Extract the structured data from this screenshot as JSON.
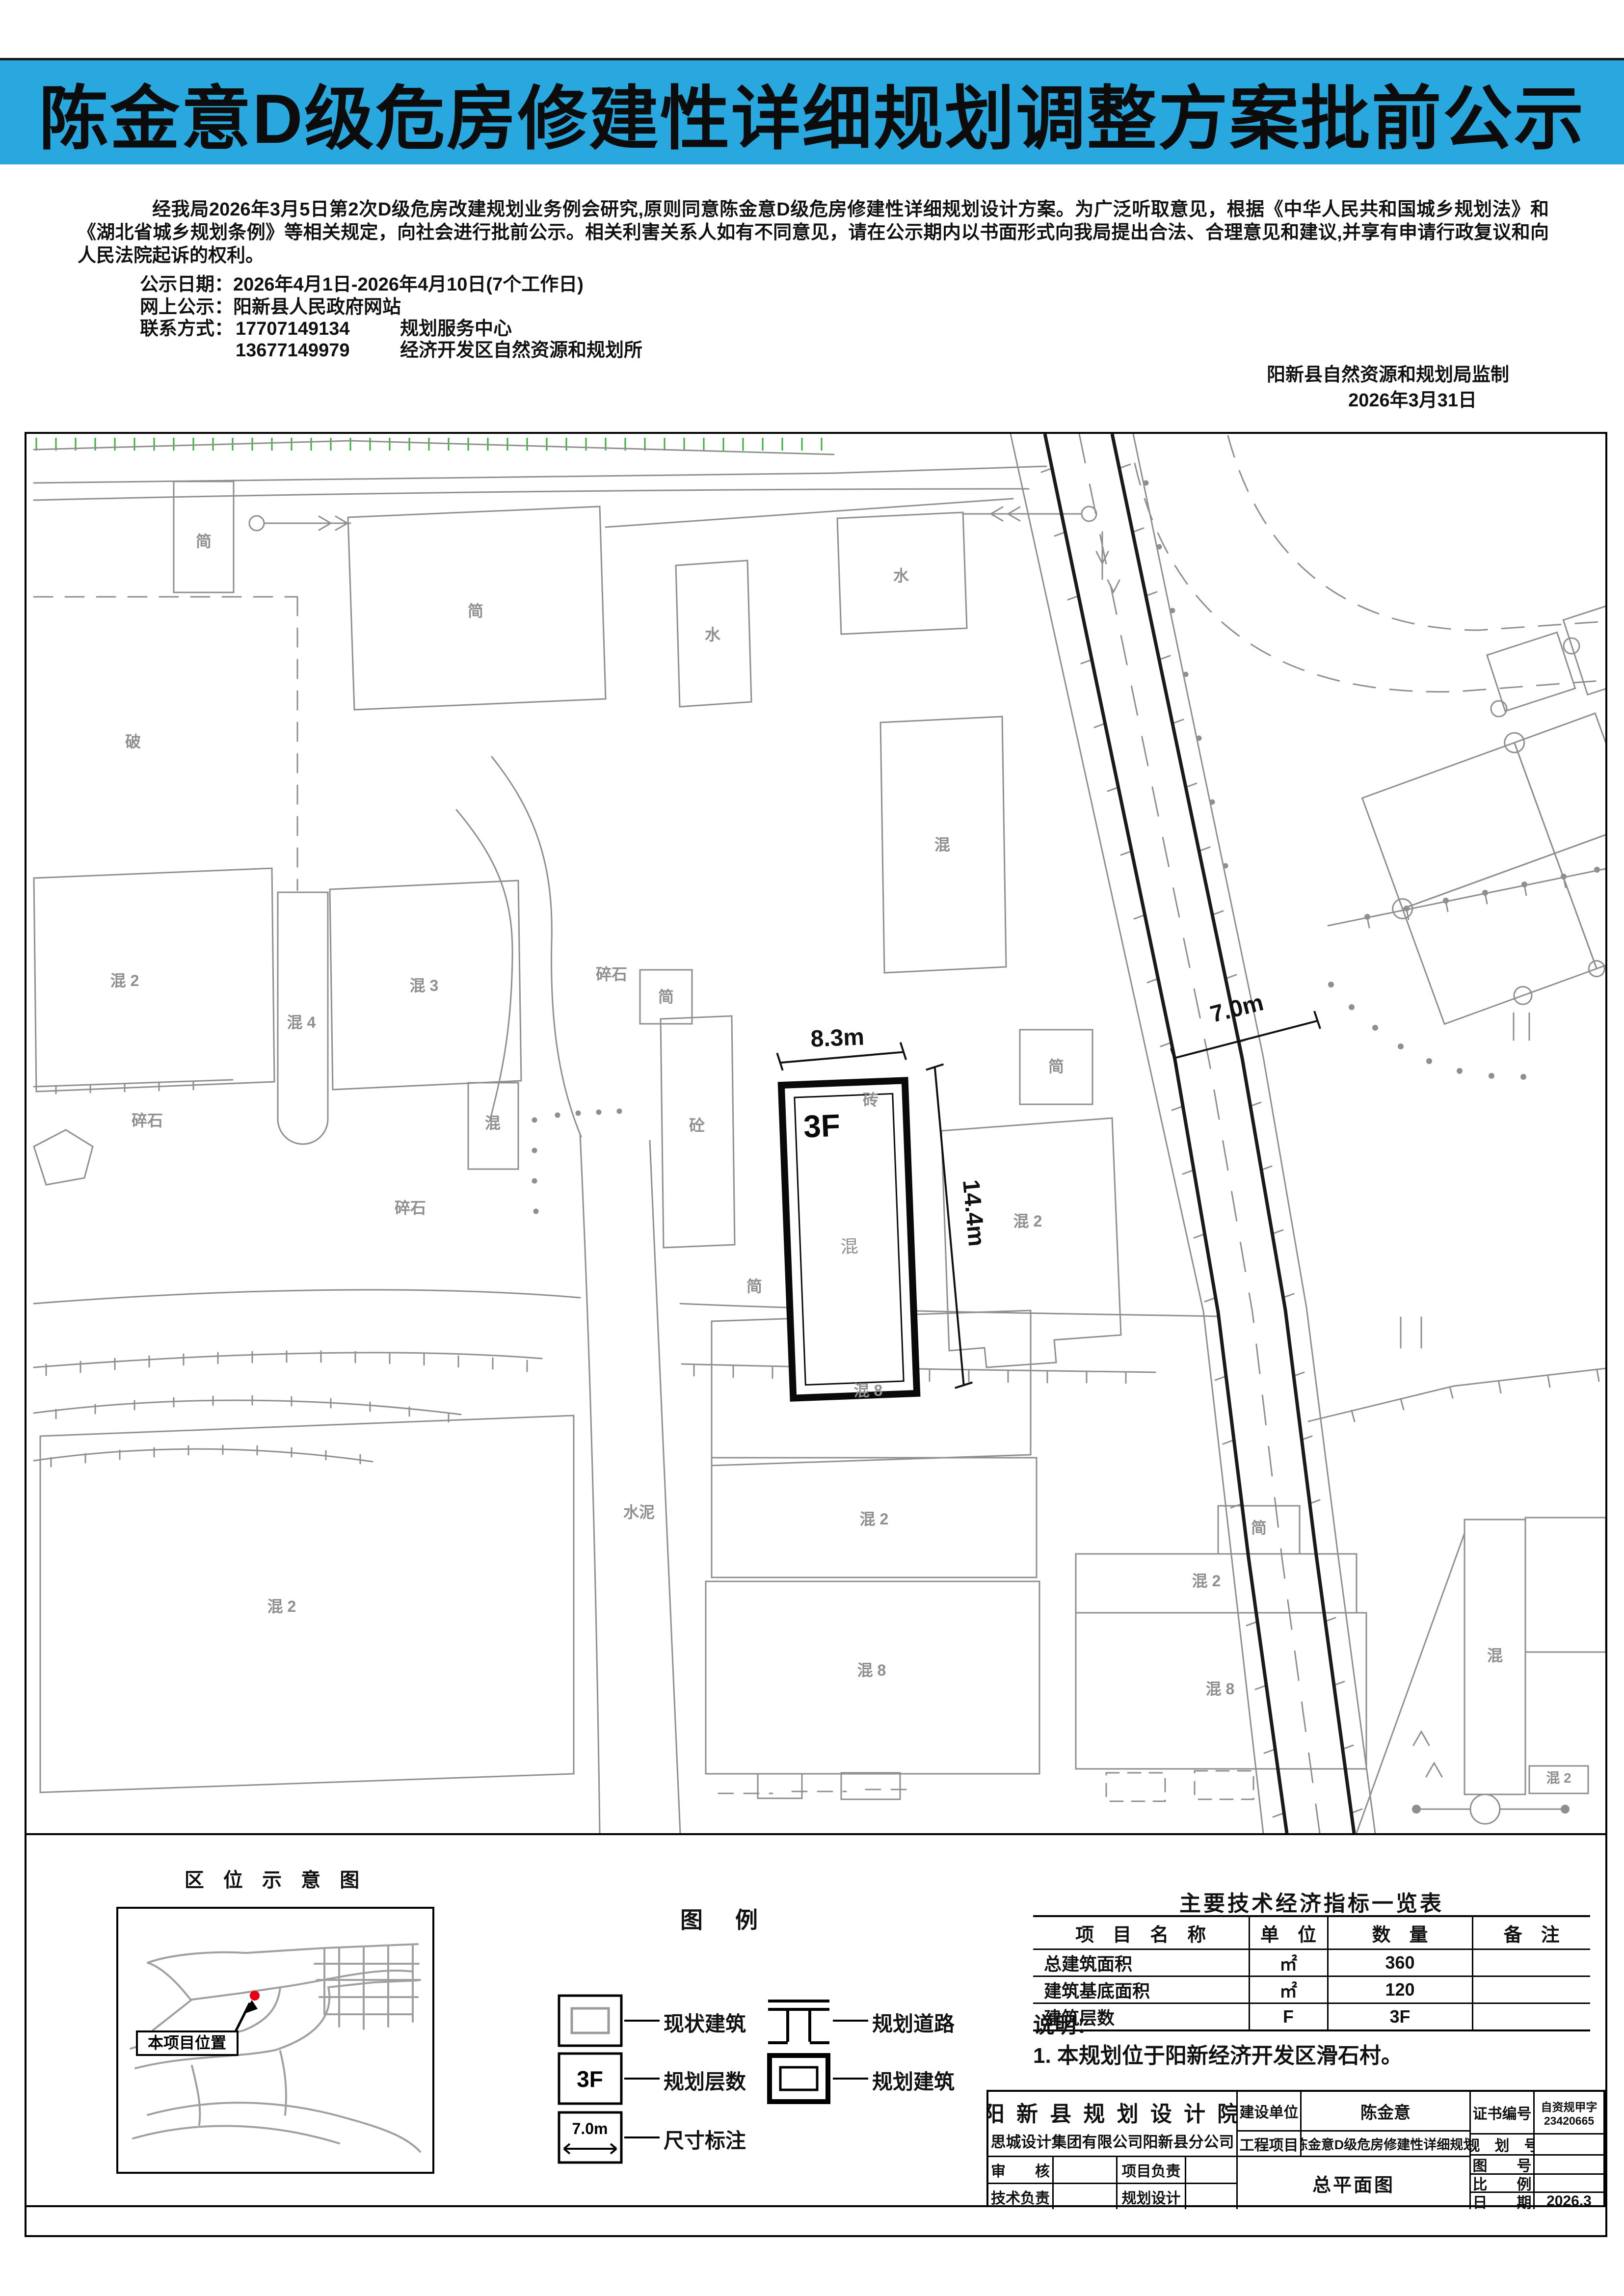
{
  "colors": {
    "banner_blue": "#29a7df",
    "vegetation_green": "#35b235",
    "map_gray": "#8f8f8f",
    "marker_red": "#e60012"
  },
  "page": {
    "title": "陈金意D级危房修建性详细规划调整方案批前公示",
    "intro": "经我局2026年3月5日第2次D级危房改建规划业务例会研究,原则同意陈金意D级危房修建性详细规划设计方案。为广泛听取意见，根据《中华人民共和国城乡规划法》和《湖北省城乡规划条例》等相关规定，向社会进行批前公示。相关利害关系人如有不同意见，请在公示期内以书面形式向我局提出合法、合理意见和建议,并享有申请行政复议和向人民法院起诉的权利。",
    "date_label": "公示日期：",
    "date_value": "2026年4月1日-2026年4月10日(7个工作日)",
    "web_label": "网上公示：",
    "web_value": "阳新县人民政府网站",
    "contact_label": "联系方式：",
    "phone1": "17707149134",
    "dept1": "规划服务中心",
    "phone2": "13677149979",
    "dept2": "经济开发区自然资源和规划所",
    "issuer": "阳新县自然资源和规划局监制",
    "issue_date": "2026年3月31日"
  },
  "map": {
    "planned": {
      "floors": "3F",
      "mat": "混"
    },
    "dims": {
      "w": "8.3m",
      "h": "14.4m",
      "road": "7.0m"
    }
  },
  "mapLabels": [
    "简",
    "简",
    "水",
    "水",
    "破",
    "混 2",
    "混 4",
    "混 3",
    "混",
    "砼",
    "碎石",
    "碎石",
    "碎石",
    "简",
    "简",
    "混 2",
    "简",
    "混",
    "砖",
    "水泥",
    "混 2",
    "混 8",
    "混 2",
    "混 8",
    "简",
    "混 2",
    "混 8",
    "混",
    "混 2"
  ],
  "location_map": {
    "title": "区 位 示 意 图",
    "marker": "本项目位置"
  },
  "legend": {
    "title": "图　例",
    "items": [
      {
        "label": "现状建筑"
      },
      {
        "label": "规划道路"
      },
      {
        "label": "规划层数",
        "symbol": "3F"
      },
      {
        "label": "规划建筑"
      },
      {
        "label": "尺寸标注",
        "symbol": "7.0m"
      }
    ]
  },
  "table": {
    "title": "主要技术经济指标一览表",
    "headers": [
      "项　目　名　称",
      "单　位",
      "数　量",
      "备　注"
    ],
    "rows": [
      [
        "总建筑面积",
        "㎡",
        "360",
        ""
      ],
      [
        "建筑基底面积",
        "㎡",
        "120",
        ""
      ],
      [
        "建筑层数",
        "F",
        "3F",
        ""
      ]
    ]
  },
  "notes": {
    "heading": "说明：",
    "line1": "1. 本规划位于阳新经济开发区滑石村。"
  },
  "titleblock": {
    "designer1": "阳 新 县 规 划 设 计 院",
    "designer2": "思城设计集团有限公司阳新县分公司",
    "client_label": "建设单位",
    "client": "陈金意",
    "project_label": "工程项目",
    "project": "陈金意D级危房修建性详细规划",
    "cert_label": "证书编号",
    "cert1": "自资规甲字",
    "cert2": "23420665",
    "plan_no": "规　划　号",
    "fig_no": "图　　号",
    "scale": "比　　例",
    "date_label": "日　　期",
    "date_value": "2026.3",
    "review": "审　　核",
    "proj_lead": "项目负责",
    "tech_lead": "技术负责",
    "plan_design": "规划设计",
    "drawing_title": "总平面图"
  }
}
